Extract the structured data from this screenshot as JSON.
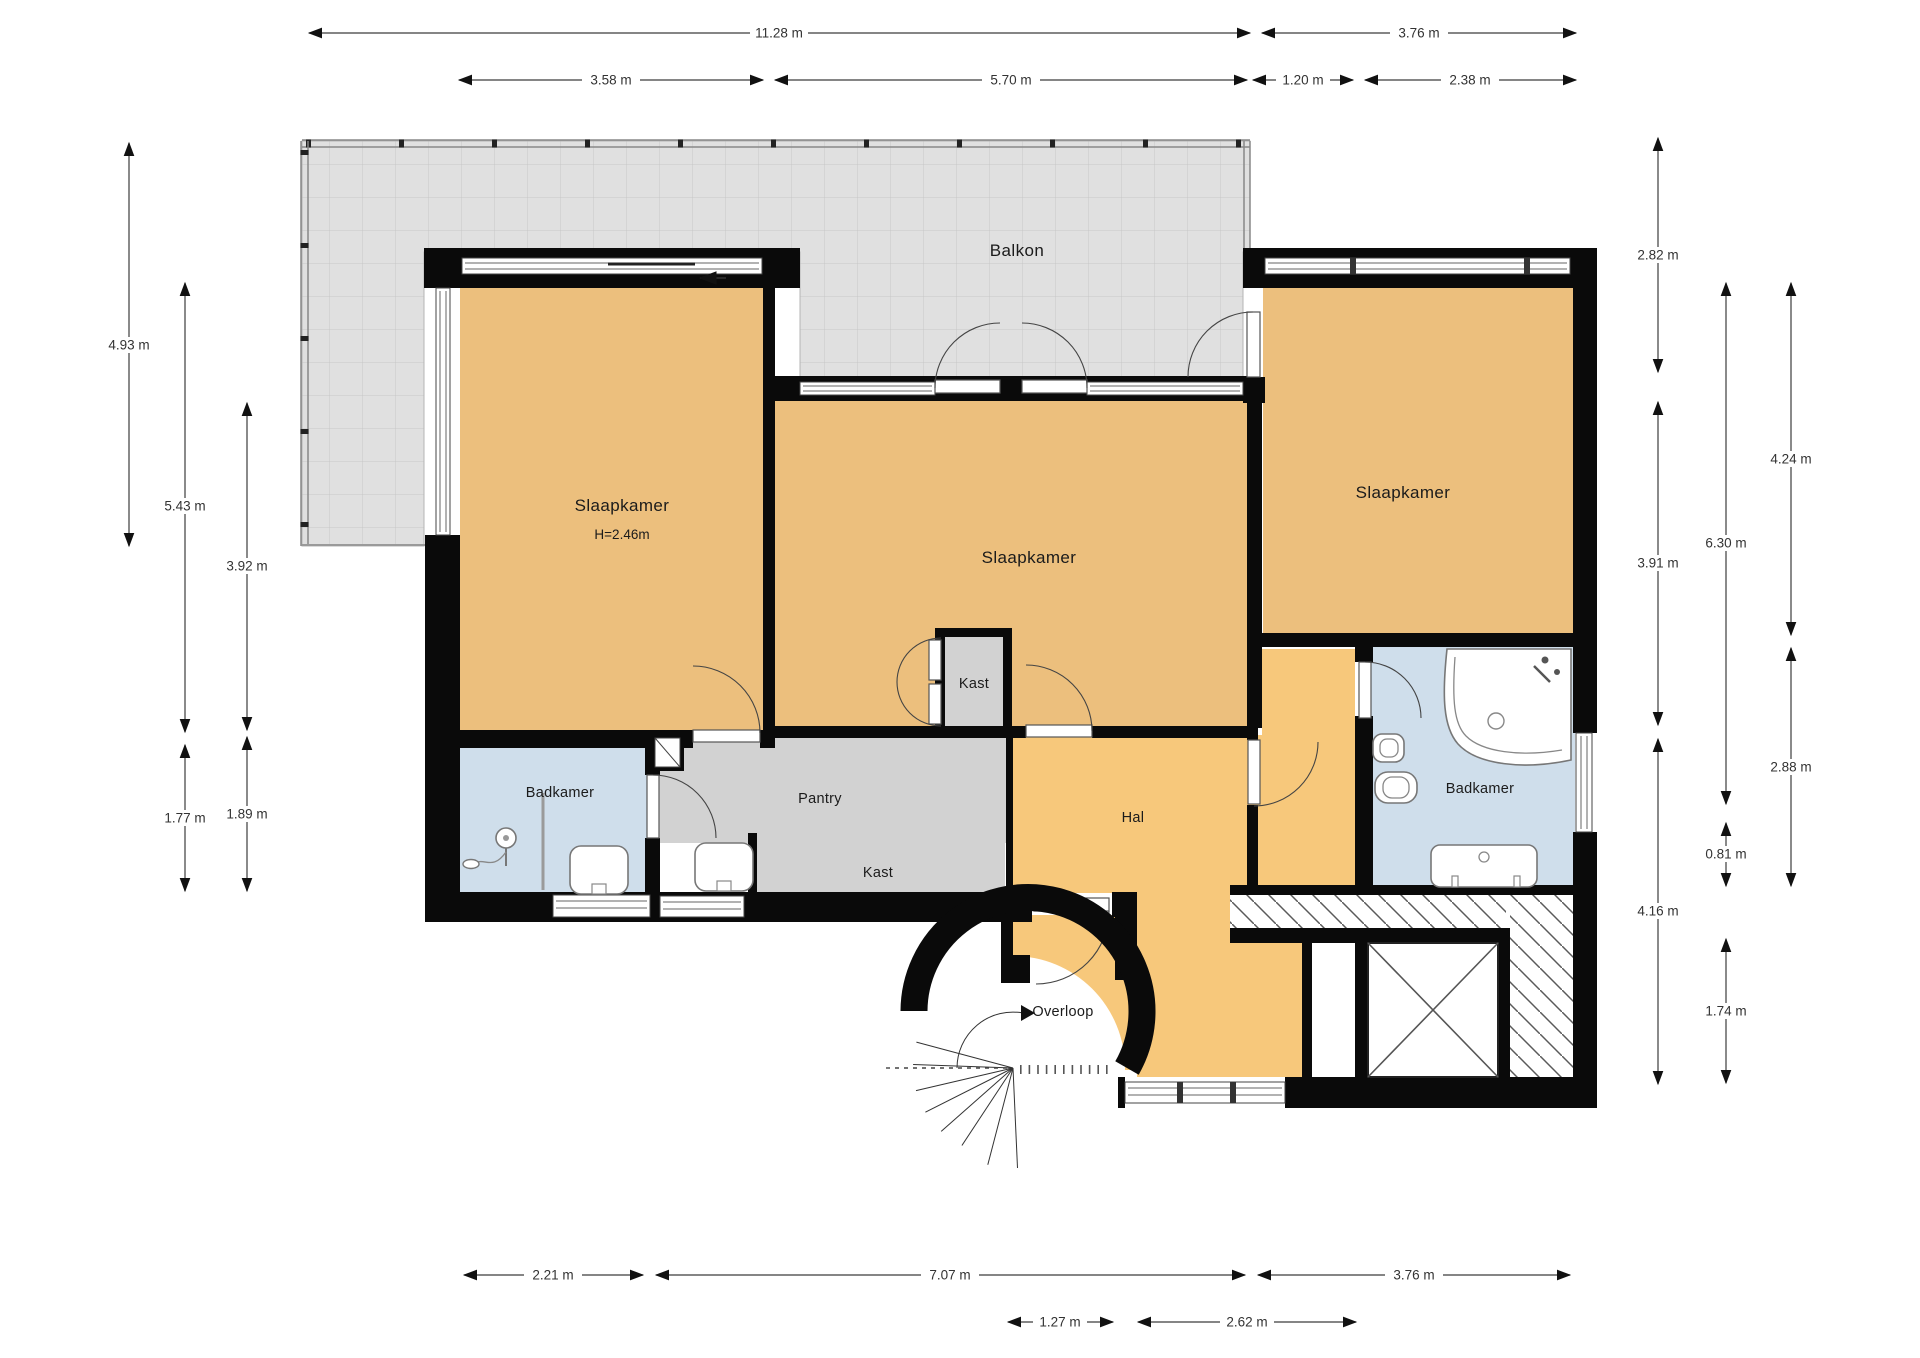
{
  "title": "Floor plan - upper storey (Dutch labels)",
  "rooms": {
    "balcony": "Balkon",
    "bedroom1": "Slaapkamer",
    "bedroom1_height": "H=2.46m",
    "bedroom2": "Slaapkamer",
    "bedroom3": "Slaapkamer",
    "bathroom_left": "Badkamer",
    "bathroom_right": "Badkamer",
    "pantry": "Pantry",
    "closet_middle": "Kast",
    "closet_bottom": "Kast",
    "hall": "Hal",
    "landing": "Overloop"
  },
  "dims": {
    "top_total_left": "11.28 m",
    "top_total_right": "3.76 m",
    "top_bedroom1": "3.58 m",
    "top_bedroom2": "5.70 m",
    "top_passage": "1.20 m",
    "top_bedroom3": "2.38 m",
    "left_balcony": "4.93 m",
    "left_bedroom1": "5.43 m",
    "left_inner": "3.92 m",
    "left_bathroom": "1.77 m",
    "left_bathroom_outer": "1.89 m",
    "right_upper": "2.82 m",
    "right_bedroom2": "3.91 m",
    "right_hall": "4.16 m",
    "right_depth": "6.30 m",
    "right_niche": "0.81 m",
    "right_elevator": "1.74 m",
    "right_bedroom3": "4.24 m",
    "right_bathroom": "2.88 m",
    "bottom_bathroom": "2.21 m",
    "bottom_middle": "7.07 m",
    "bottom_right": "3.76 m",
    "bottom_landing": "1.27 m",
    "bottom_hall": "2.62 m"
  },
  "colors": {
    "bedroom": "#ecbf7d",
    "hall": "#f7c87b",
    "bathroom": "#cfdeeb",
    "closet": "#d2d2d2",
    "balcony": "#e0e0e0",
    "wall": "#0a0a0a",
    "dim": "#333333"
  }
}
